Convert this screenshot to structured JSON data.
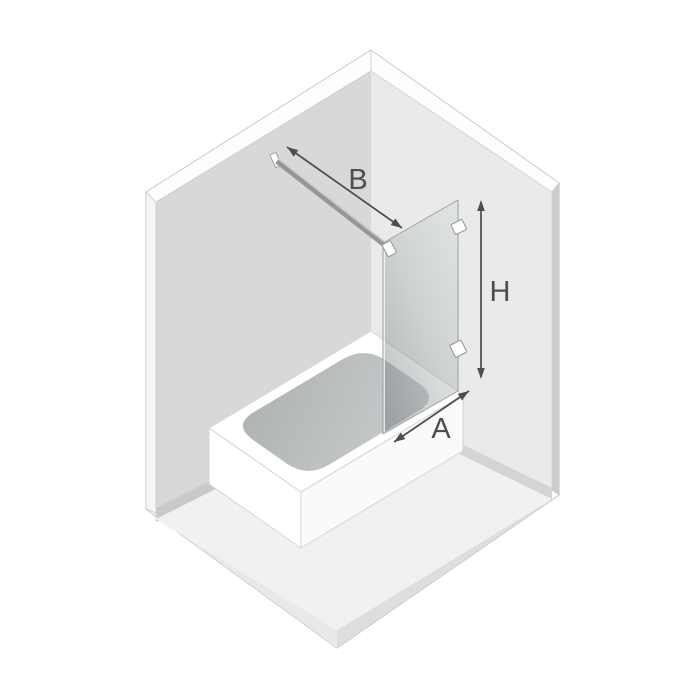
{
  "diagram": {
    "subject": "Isometric dimension diagram of a corner room with a bathtub, a fixed glass bath screen on the tub rim, and a wall-mounted support bar",
    "labels": {
      "bar_length": "B",
      "screen_height": "H",
      "screen_width": "A"
    },
    "colors": {
      "background": "#ffffff",
      "wall_left": "#d8d8d8",
      "wall_right": "#eaeaea",
      "wall_trim": "#fdfdfd",
      "wall_outer_edge_left": "#f6f6f6",
      "wall_outer_edge_right": "#cdcdcd",
      "wall_base_shadow_left": "#c9c9c9",
      "wall_base_shadow_right": "#d4d4d4",
      "floor": "#f1f1f1",
      "floor_slab_left": "#e9e9e9",
      "floor_slab_right": "#dedede",
      "room_fill": "#fcfcfc",
      "tub": "#ffffff",
      "tub_face_right": "#fafafa",
      "basin_gradient_start": "#aeb2b2",
      "basin_gradient_end": "#c9cdcd",
      "glass_edge": "#99a0a3",
      "hardware_fill": "#ffffff",
      "hardware_edge": "#8e9496",
      "bar": "#969696",
      "arrow": "#4d4d4d",
      "label_text": "#4d4d4d"
    }
  }
}
